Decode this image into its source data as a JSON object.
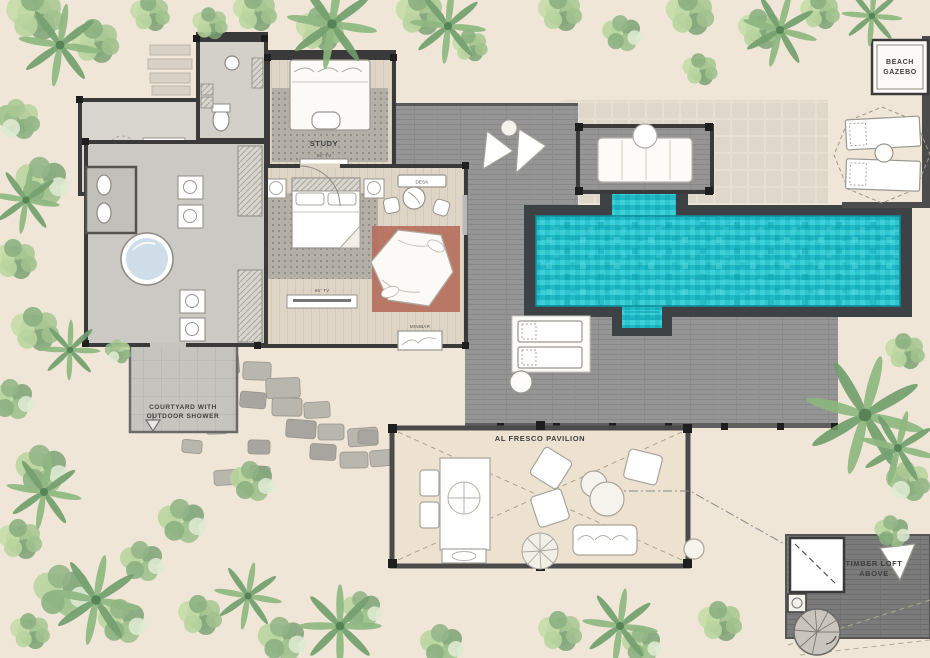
{
  "plan": {
    "type": "resort-villa-floor-plan",
    "labels": {
      "gazebo_1": "BEACH",
      "gazebo_2": "GAZEBO",
      "study": "STUDY",
      "study_tv": "55\" TV",
      "desk": "DESK",
      "bedroom_tv": "65\" TV",
      "minibar": "MINIBAR",
      "courtyard_1": "COURTYARD WITH",
      "courtyard_2": "OUTDOOR SHOWER",
      "pavilion": "AL FRESCO PAVILION",
      "loft_1": "TIMBER LOFT",
      "loft_2": "ABOVE"
    },
    "colors": {
      "sand": "#efe6d7",
      "deck": "#949494",
      "deck_dark": "#7b7b7b",
      "pool_water": "#25c2cb",
      "pool_border": "#3d4345",
      "wall": "#3a3a3a",
      "interior_floor": "#ded5c6",
      "bathroom_floor": "#cbc9c3",
      "rug": "#b4b0a8",
      "copper_platform": "#b5705c",
      "pavilion_floor": "#ece2cf",
      "stone_tile": "#ded7c9",
      "tub_water": "#cfdde8",
      "foliage_light": "#c3dba6",
      "foliage_mid": "#8fb483",
      "foliage_dark": "#6f9d6b",
      "label_text": "#3f3f3f"
    }
  }
}
